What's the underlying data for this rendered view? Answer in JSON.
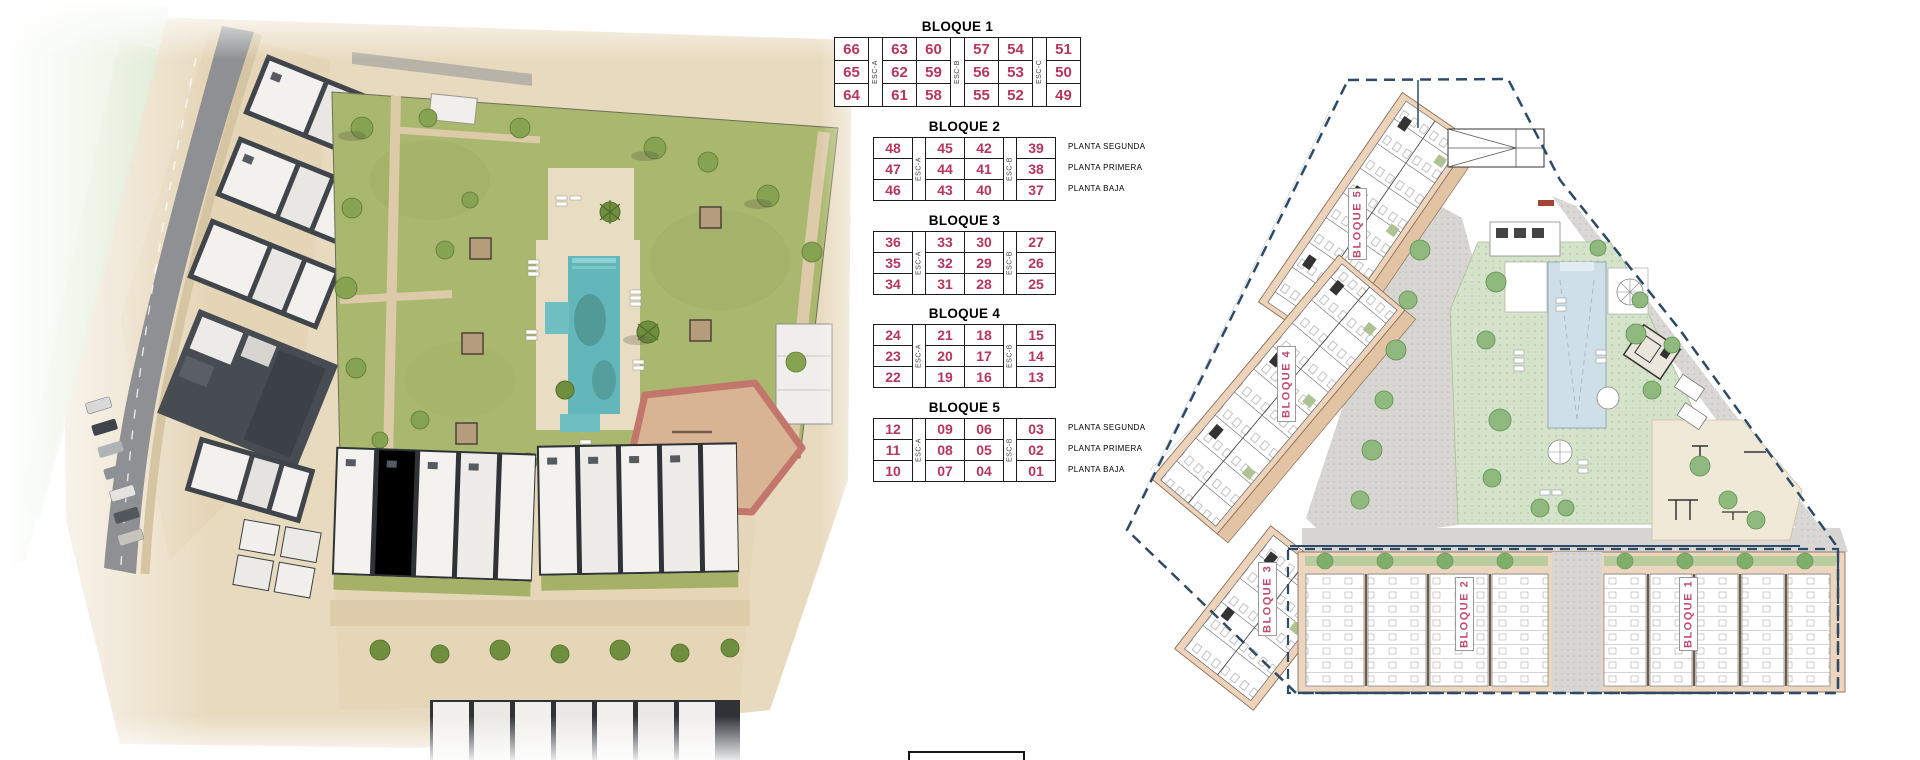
{
  "tables": [
    {
      "title": "BLOQUE 1",
      "stairs": [
        "ESC-A",
        "ESC-B",
        "ESC-C"
      ],
      "rows": [
        [
          "66",
          "63",
          "60",
          "57",
          "54",
          "51"
        ],
        [
          "65",
          "62",
          "59",
          "56",
          "53",
          "50"
        ],
        [
          "64",
          "61",
          "58",
          "55",
          "52",
          "49"
        ]
      ],
      "planta_labels": []
    },
    {
      "title": "BLOQUE 2",
      "stairs": [
        "ESC-A",
        "ESC-B"
      ],
      "rows": [
        [
          "48",
          "45",
          "42",
          "39"
        ],
        [
          "47",
          "44",
          "41",
          "38"
        ],
        [
          "46",
          "43",
          "40",
          "37"
        ]
      ],
      "planta_labels": [
        "PLANTA SEGUNDA",
        "PLANTA PRIMERA",
        "PLANTA BAJA"
      ]
    },
    {
      "title": "BLOQUE 3",
      "stairs": [
        "ESC-A",
        "ESC-B"
      ],
      "rows": [
        [
          "36",
          "33",
          "30",
          "27"
        ],
        [
          "35",
          "32",
          "29",
          "26"
        ],
        [
          "34",
          "31",
          "28",
          "25"
        ]
      ],
      "planta_labels": []
    },
    {
      "title": "BLOQUE 4",
      "stairs": [
        "ESC-A",
        "ESC-B"
      ],
      "rows": [
        [
          "24",
          "21",
          "18",
          "15"
        ],
        [
          "23",
          "20",
          "17",
          "14"
        ],
        [
          "22",
          "19",
          "16",
          "13"
        ]
      ],
      "planta_labels": []
    },
    {
      "title": "BLOQUE 5",
      "stairs": [
        "ESC-A",
        "ESC-B"
      ],
      "rows": [
        [
          "12",
          "09",
          "06",
          "03"
        ],
        [
          "11",
          "08",
          "05",
          "02"
        ],
        [
          "10",
          "07",
          "04",
          "01"
        ]
      ],
      "planta_labels": [
        "PLANTA SEGUNDA",
        "PLANTA PRIMERA",
        "PLANTA BAJA"
      ]
    }
  ],
  "site_plan": {
    "block_labels": [
      "BLOQUE 5",
      "BLOQUE 4",
      "BLOQUE 3",
      "BLOQUE 2",
      "BLOQUE 1"
    ]
  },
  "colors": {
    "number": "#b8355c",
    "plabel": "#c6496d",
    "boundary": "#2d4a68",
    "pool": "#63b7ba",
    "lawn": "#a9b86d",
    "plan_tan": "#ecd3ba",
    "plan_green": "#d4e3ca"
  }
}
